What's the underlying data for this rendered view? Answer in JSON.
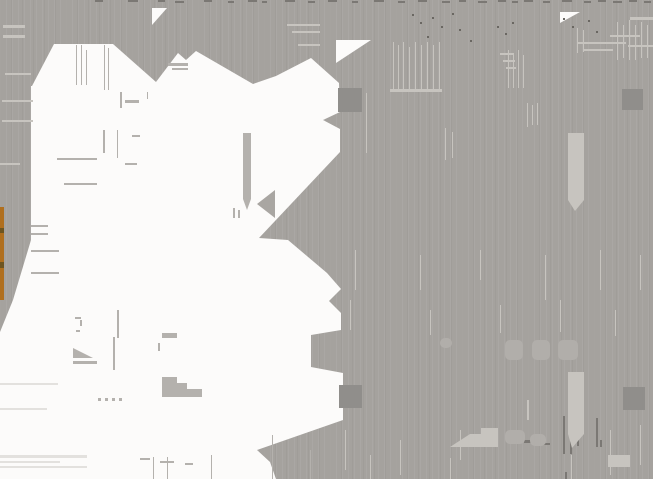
{
  "canvas": {
    "width": 653,
    "height": 479
  },
  "colors": {
    "background": "#a5a29e",
    "white": "#fcfbfa",
    "handle": "#908e8b",
    "light": "#c7c4bf",
    "lighter": "#e3e1de",
    "ghost": "#b1aeaa",
    "gray_on_white": "#b4b1ad",
    "gray_on_white_dark": "#a9a6a2",
    "dark": "#7b7874",
    "speckle": "#6a6762",
    "orange": "#b06f1e",
    "orange_gap": "#6e5520"
  },
  "shapes": {
    "white_region": "32,86 54,44 113,44 156,82 178,53 186,60 196,51 253,84 276,76 311,58 339,83 340,112 323,120 340,129 340,152 259,238 288,240 327,273 341,289 329,301 341,313 341,330 311,335 311,367 343,373 343,420 257,450 270,462 276,479 0,479 0,332 13,300 31,240 31,86",
    "white_wedges": [
      "152,8 167,8 152,25",
      "336,40 371,40 336,63",
      "560,12 580,12 560,23"
    ]
  },
  "figures": [
    {
      "name": "orange-accent-strip",
      "type": "rect",
      "rect": [
        0,
        207,
        4,
        93
      ],
      "color": "orange"
    },
    {
      "name": "orange-strip-gap-1",
      "type": "rect",
      "rect": [
        0,
        228,
        4,
        5
      ],
      "color": "orange_gap"
    },
    {
      "name": "orange-strip-gap-2",
      "type": "rect",
      "rect": [
        0,
        262,
        4,
        6
      ],
      "color": "orange_gap"
    },
    {
      "name": "cursor-bar-artifact",
      "type": "rect",
      "rect": [
        243,
        133,
        8,
        66
      ],
      "color": "gray_on_white"
    },
    {
      "name": "cursor-bar-tip",
      "type": "polygon",
      "points": "243,199 251,199 247,210",
      "color": "gray_on_white"
    },
    {
      "name": "left-arrow-artifact",
      "type": "polygon",
      "points": "275,190 275,218 257,204",
      "color": "gray_on_white_dark"
    },
    {
      "name": "small-triangle-artifact",
      "type": "polygon",
      "points": "73,348 93,358 73,358",
      "color": "gray_on_white"
    },
    {
      "name": "small-triangle-underline",
      "type": "rect",
      "rect": [
        73,
        361,
        24,
        3
      ],
      "color": "gray_on_white"
    },
    {
      "name": "staircase-artifact",
      "type": "polygon",
      "points": "162,377 177,377 177,383 187,383 187,389 202,389 202,397 162,397",
      "color": "gray_on_white"
    },
    {
      "name": "small-wedge-artifact",
      "type": "rect",
      "rect": [
        162,
        333,
        15,
        5
      ],
      "color": "gray_on_white"
    },
    {
      "name": "small-tick-artifact",
      "type": "rect",
      "rect": [
        158,
        343,
        2,
        8
      ],
      "color": "gray_on_white"
    },
    {
      "name": "pennant-artifact-1",
      "type": "rect",
      "rect": [
        568,
        133,
        16,
        67
      ],
      "color": "light"
    },
    {
      "name": "pennant-artifact-1-tip",
      "type": "polygon",
      "points": "568,200 584,200 575,211",
      "color": "light"
    },
    {
      "name": "pennant-artifact-2",
      "type": "rect",
      "rect": [
        568,
        372,
        16,
        62
      ],
      "color": "light"
    },
    {
      "name": "pennant-artifact-2-tip",
      "type": "polygon",
      "points": "568,434 584,434 572,448",
      "color": "light"
    },
    {
      "name": "light-staircase-artifact",
      "type": "polygon",
      "points": "450,447 470,434 481,434 481,428 498,428 498,447",
      "color": "light"
    },
    {
      "name": "light-block-artifact",
      "type": "rect",
      "rect": [
        608,
        455,
        22,
        12
      ],
      "color": "light"
    }
  ],
  "selection_handles": [
    {
      "name": "selection-handle-top-left",
      "rect": [
        338,
        88,
        24,
        24
      ]
    },
    {
      "name": "selection-handle-top-right",
      "rect": [
        622,
        89,
        21,
        21
      ]
    },
    {
      "name": "selection-handle-bottom-left",
      "rect": [
        339,
        385,
        23,
        23
      ]
    },
    {
      "name": "selection-handle-bottom-right",
      "rect": [
        623,
        387,
        22,
        23
      ]
    }
  ],
  "artifacts": {
    "top_edge_dashes": [
      [
        95,
        0,
        8
      ],
      [
        128,
        0,
        10
      ],
      [
        158,
        0,
        7
      ],
      [
        175,
        1,
        9
      ],
      [
        204,
        0,
        8
      ],
      [
        228,
        1,
        6
      ],
      [
        248,
        0,
        9
      ],
      [
        262,
        1,
        5
      ],
      [
        285,
        0,
        10
      ],
      [
        308,
        1,
        7
      ],
      [
        328,
        0,
        9
      ],
      [
        352,
        1,
        6
      ],
      [
        374,
        0,
        10
      ],
      [
        398,
        1,
        7
      ],
      [
        418,
        0,
        9
      ],
      [
        442,
        1,
        8
      ],
      [
        459,
        0,
        7
      ],
      [
        478,
        1,
        9
      ],
      [
        498,
        0,
        8
      ],
      [
        512,
        1,
        6
      ],
      [
        524,
        0,
        9
      ],
      [
        543,
        1,
        7
      ],
      [
        562,
        0,
        10
      ],
      [
        584,
        1,
        7
      ],
      [
        598,
        0,
        8
      ],
      [
        613,
        1,
        9
      ],
      [
        629,
        0,
        8
      ],
      [
        644,
        1,
        7
      ]
    ],
    "speckles": [
      [
        412,
        14
      ],
      [
        420,
        22
      ],
      [
        432,
        17
      ],
      [
        441,
        26
      ],
      [
        452,
        13
      ],
      [
        459,
        29
      ],
      [
        497,
        26
      ],
      [
        505,
        33
      ],
      [
        512,
        22
      ],
      [
        563,
        18
      ],
      [
        572,
        26
      ],
      [
        588,
        20
      ],
      [
        596,
        31
      ],
      [
        470,
        40
      ],
      [
        427,
        36
      ]
    ],
    "light_on_gray": [
      [
        393,
        42,
        1,
        48
      ],
      [
        398,
        45,
        1,
        45
      ],
      [
        403,
        42,
        1,
        48
      ],
      [
        409,
        47,
        1,
        43
      ],
      [
        415,
        42,
        1,
        48
      ],
      [
        421,
        45,
        1,
        45
      ],
      [
        427,
        42,
        1,
        48
      ],
      [
        433,
        45,
        1,
        45
      ],
      [
        439,
        42,
        1,
        48
      ],
      [
        390,
        89,
        52,
        3
      ],
      [
        508,
        50,
        1,
        38
      ],
      [
        513,
        53,
        1,
        35
      ],
      [
        518,
        50,
        1,
        38
      ],
      [
        523,
        55,
        1,
        33
      ],
      [
        366,
        93,
        1,
        60
      ],
      [
        445,
        128,
        1,
        32
      ],
      [
        452,
        132,
        1,
        26
      ],
      [
        527,
        103,
        1,
        24
      ],
      [
        532,
        105,
        1,
        20
      ],
      [
        537,
        103,
        1,
        22
      ],
      [
        577,
        28,
        1,
        25
      ],
      [
        583,
        30,
        1,
        22
      ],
      [
        617,
        22,
        1,
        38
      ],
      [
        623,
        25,
        1,
        33
      ],
      [
        629,
        20,
        1,
        40
      ],
      [
        635,
        25,
        1,
        35
      ],
      [
        641,
        22,
        1,
        36
      ],
      [
        647,
        25,
        1,
        33
      ],
      [
        578,
        42,
        48,
        2
      ],
      [
        583,
        49,
        30,
        2
      ],
      [
        500,
        53,
        14,
        2
      ],
      [
        503,
        60,
        12,
        2
      ],
      [
        506,
        67,
        10,
        2
      ],
      [
        610,
        35,
        30,
        2
      ],
      [
        628,
        45,
        25,
        2
      ],
      [
        630,
        17,
        23,
        3
      ],
      [
        287,
        24,
        33,
        2
      ],
      [
        292,
        31,
        28,
        2
      ],
      [
        298,
        44,
        22,
        2
      ],
      [
        3,
        25,
        22,
        3
      ],
      [
        3,
        35,
        22,
        3
      ],
      [
        5,
        73,
        26,
        2
      ],
      [
        2,
        100,
        31,
        2
      ],
      [
        2,
        120,
        31,
        2
      ],
      [
        0,
        163,
        20,
        2
      ],
      [
        355,
        250,
        1,
        40
      ],
      [
        420,
        255,
        1,
        35
      ],
      [
        480,
        250,
        1,
        30
      ],
      [
        545,
        255,
        1,
        45
      ],
      [
        600,
        250,
        1,
        40
      ],
      [
        640,
        255,
        1,
        35
      ],
      [
        350,
        300,
        1,
        30
      ],
      [
        430,
        310,
        1,
        25
      ],
      [
        500,
        305,
        1,
        28
      ],
      [
        560,
        300,
        1,
        32
      ],
      [
        615,
        310,
        1,
        26
      ],
      [
        345,
        430,
        1,
        40
      ],
      [
        400,
        440,
        1,
        35
      ],
      [
        460,
        430,
        1,
        30
      ],
      [
        610,
        430,
        1,
        45
      ],
      [
        640,
        425,
        1,
        40
      ],
      [
        370,
        455,
        1,
        24
      ],
      [
        450,
        458,
        1,
        21
      ],
      [
        527,
        400,
        2,
        20
      ],
      [
        571,
        455,
        1,
        24
      ]
    ],
    "dark_on_gray": [
      [
        563,
        416,
        2,
        38
      ],
      [
        570,
        420,
        2,
        34
      ],
      [
        577,
        416,
        2,
        30
      ],
      [
        507,
        436,
        14,
        3
      ],
      [
        524,
        440,
        12,
        3
      ],
      [
        540,
        443,
        10,
        2
      ],
      [
        596,
        418,
        2,
        29
      ],
      [
        600,
        440,
        2,
        7
      ],
      [
        565,
        472,
        2,
        7
      ]
    ],
    "gray_on_white": [
      [
        76,
        45,
        1,
        40
      ],
      [
        81,
        45,
        1,
        40
      ],
      [
        86,
        50,
        1,
        35
      ],
      [
        104,
        45,
        1,
        45
      ],
      [
        108,
        48,
        1,
        42
      ],
      [
        120,
        92,
        2,
        16
      ],
      [
        147,
        92,
        1,
        7
      ],
      [
        125,
        100,
        14,
        3
      ],
      [
        117,
        130,
        1,
        28
      ],
      [
        103,
        130,
        2,
        23
      ],
      [
        132,
        135,
        8,
        2
      ],
      [
        125,
        163,
        12,
        2
      ],
      [
        57,
        158,
        40,
        2
      ],
      [
        64,
        183,
        33,
        2
      ],
      [
        168,
        63,
        20,
        3
      ],
      [
        172,
        68,
        16,
        2
      ],
      [
        113,
        337,
        2,
        33
      ],
      [
        117,
        310,
        2,
        28
      ],
      [
        31,
        225,
        17,
        2
      ],
      [
        31,
        233,
        17,
        2
      ],
      [
        31,
        250,
        28,
        2
      ],
      [
        31,
        272,
        28,
        2
      ],
      [
        140,
        458,
        10,
        2
      ],
      [
        160,
        461,
        14,
        2
      ],
      [
        185,
        463,
        8,
        2
      ],
      [
        233,
        208,
        2,
        10
      ],
      [
        238,
        210,
        2,
        8
      ],
      [
        75,
        317,
        6,
        2
      ],
      [
        80,
        320,
        2,
        6
      ],
      [
        76,
        330,
        4,
        2
      ],
      [
        98,
        398,
        3,
        3
      ],
      [
        105,
        398,
        3,
        3
      ],
      [
        112,
        398,
        3,
        3
      ],
      [
        119,
        398,
        3,
        3
      ],
      [
        153,
        457,
        1,
        22
      ],
      [
        167,
        457,
        1,
        22
      ],
      [
        272,
        435,
        1,
        44
      ],
      [
        310,
        450,
        1,
        29
      ],
      [
        211,
        455,
        1,
        24
      ]
    ],
    "lighter_on_white": [
      [
        0,
        455,
        87,
        3
      ],
      [
        0,
        461,
        60,
        2
      ],
      [
        0,
        466,
        87,
        2
      ],
      [
        0,
        383,
        58,
        2
      ],
      [
        0,
        408,
        47,
        2
      ]
    ],
    "ghost_blobs": [
      [
        505,
        340,
        18,
        20
      ],
      [
        532,
        340,
        18,
        20
      ],
      [
        558,
        340,
        20,
        20
      ],
      [
        440,
        338,
        12,
        10
      ],
      [
        505,
        430,
        20,
        14
      ],
      [
        530,
        434,
        16,
        12
      ]
    ]
  }
}
